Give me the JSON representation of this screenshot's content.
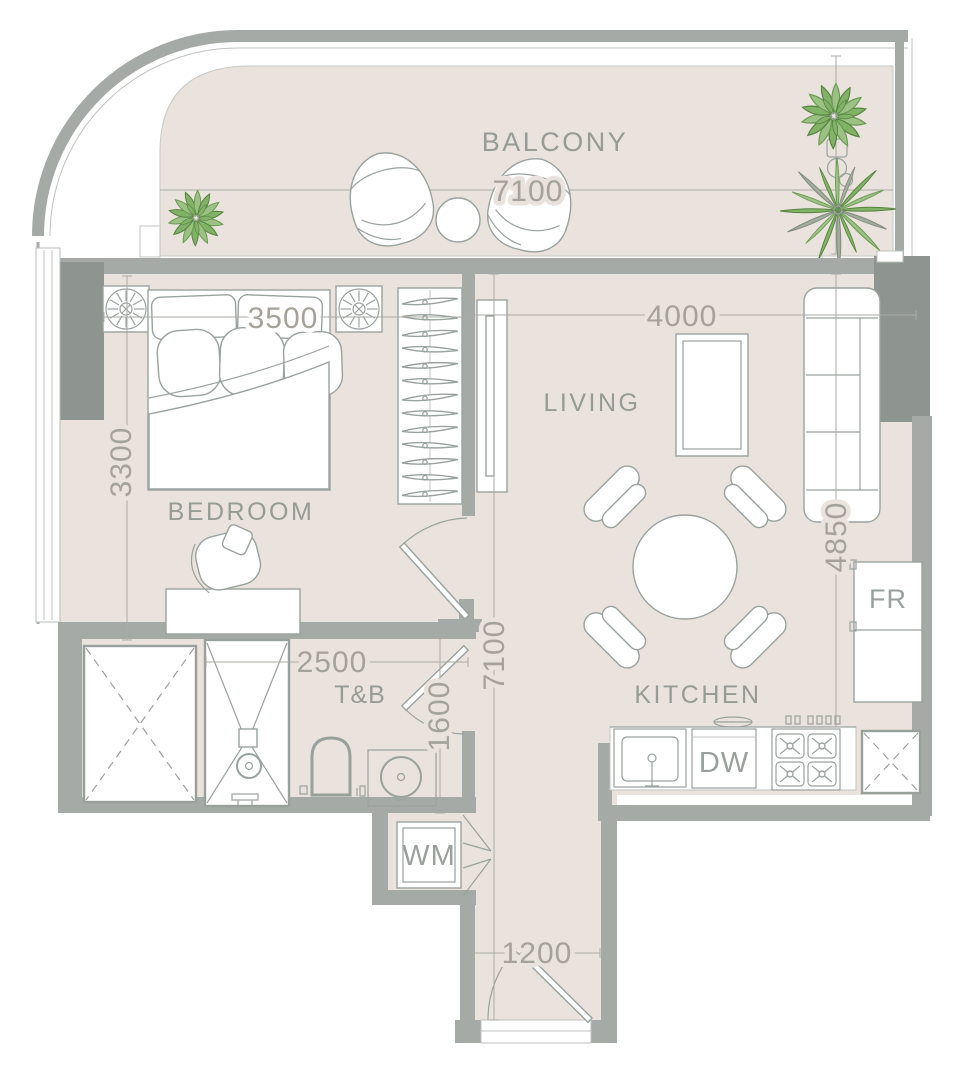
{
  "plan": {
    "labels": {
      "balcony": "BALCONY",
      "bedroom": "BEDROOM",
      "living": "LIVING",
      "kitchen": "KITCHEN",
      "toilet_bath": "T&B"
    },
    "appliances": {
      "fridge": "FR",
      "dishwasher": "DW",
      "washing_machine": "WM"
    },
    "dimensions": {
      "balcony_width": "7100",
      "bedroom_width": "3500",
      "bedroom_length": "3300",
      "living_width": "4000",
      "living_length": "4850",
      "hall_length": "7100",
      "tb_width": "2500",
      "tb_length": "1600",
      "entry_width": "1200"
    },
    "colors": {
      "floor": "#eae2dc",
      "wall": "#a6aaa7",
      "pier": "#8e9591",
      "furniture_line": "#9aa29e",
      "dim_text": "#a5a29c",
      "label_text": "#979b96",
      "plant_green": "#82b267",
      "plant_dark": "#578240",
      "palm_gray": "#a3ac9e"
    }
  }
}
